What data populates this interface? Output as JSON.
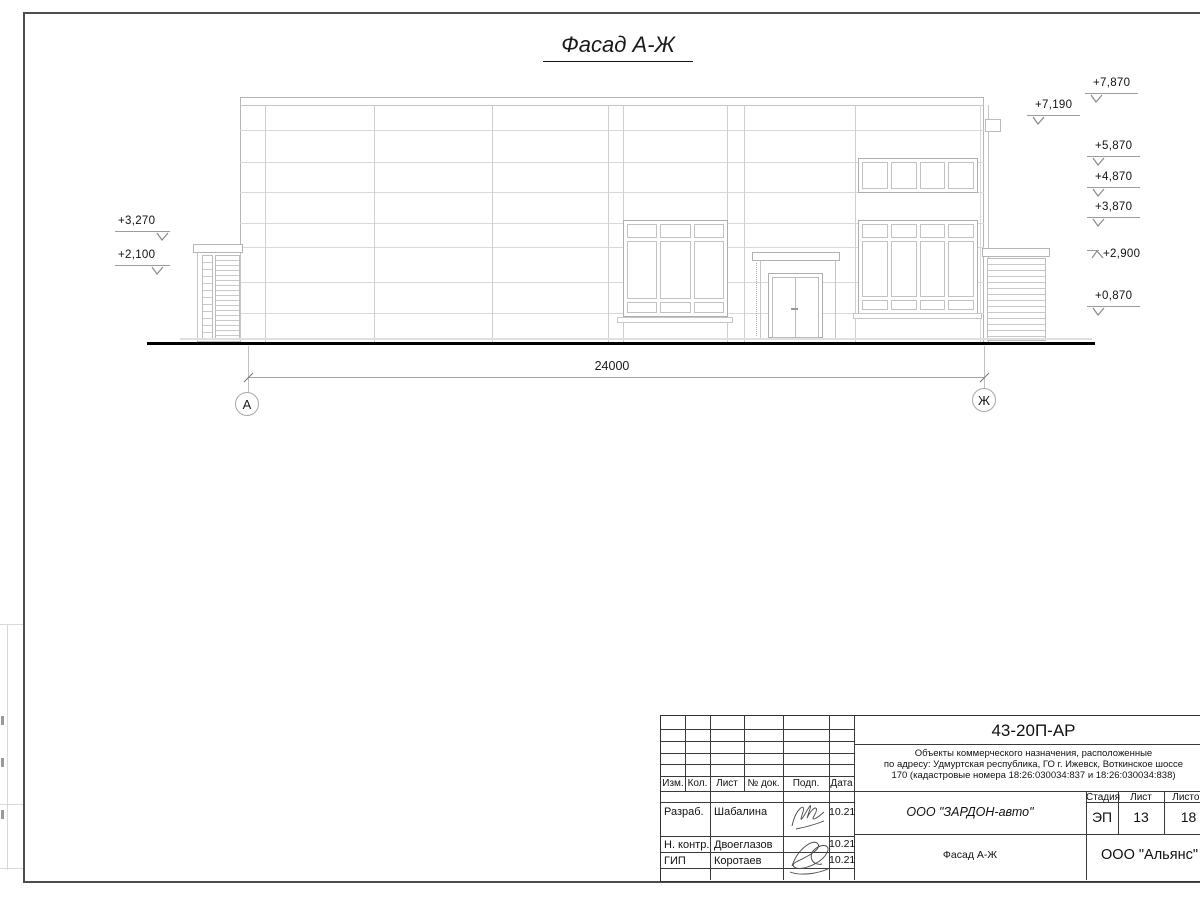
{
  "sheet_title": "Фасад А-Ж",
  "drawing": {
    "dimension_total": "24000",
    "axis_left": "А",
    "axis_right": "Ж",
    "elevations_left": [
      "+3,270",
      "+2,100"
    ],
    "elevations_right": [
      "+7,870",
      "+7,190",
      "+5,870",
      "+4,870",
      "+3,870",
      "+2,900",
      "+0,870"
    ]
  },
  "title_block": {
    "doc_code": "43-20П-АР",
    "description": [
      "Объекты коммерческого назначения, расположенные",
      "по адресу: Удмуртская республика, ГО г. Ижевск, Воткинское шоссе",
      "170 (кадастровые номера 18:26:030034:837 и 18:26:030034:838)"
    ],
    "columns": [
      "Изм.",
      "Кол.",
      "Лист",
      "№ док.",
      "Подп.",
      "Дата"
    ],
    "rows": [
      {
        "role": "Разраб.",
        "name": "Шабалина",
        "date": "10.21"
      },
      {
        "role": "Н. контр.",
        "name": "Двоеглазов",
        "date": "10.21"
      },
      {
        "role": "ГИП",
        "name": "Коротаев",
        "date": "10.21"
      }
    ],
    "organization": "ООО \"ЗАРДОН-авто\"",
    "stage_label": "Стадия",
    "sheet_label": "Лист",
    "sheets_label": "Листов",
    "stage": "ЭП",
    "sheet_number": "13",
    "sheets_total": "18",
    "drawing_name": "Фасад А-Ж",
    "contractor": "ООО \"Альянс\""
  }
}
